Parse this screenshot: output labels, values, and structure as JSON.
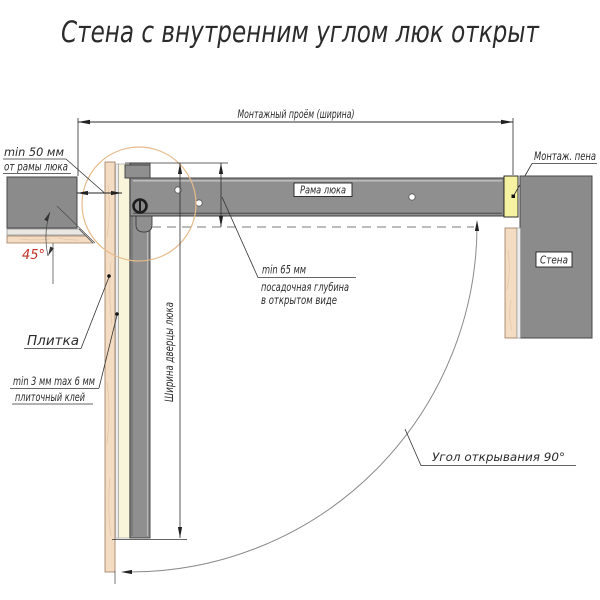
{
  "title": "Стена с внутренним углом люк открыт",
  "colors": {
    "wall_gray": "#8b8b8b",
    "frame_gray": "#8f8f8f",
    "tile_beige": "#f4dcc3",
    "adhesive_cream": "#f8f5da",
    "foam_yellow": "#f5f2a2",
    "detail_circle_orange": "#e7ba8b",
    "annotation_red": "#c43127",
    "line_dark": "#2e2e2e"
  },
  "labels": {
    "mounting_opening": "Монтажный проём (ширина)",
    "min50_line1": "min 50 мм",
    "min50_line2": "от рамы люка",
    "angle45": "45°",
    "tile": "Плитка",
    "adhesive_line1": "min 3 мм max 6 мм",
    "adhesive_line2": "плиточный клей",
    "frame": "Рама люка",
    "foam": "Монтаж. пена",
    "wall": "Стена",
    "depth_line1": "min 65 мм",
    "depth_line2": "посадочная глубина",
    "depth_line3": "в открытом виде",
    "door_width": "Ширина дверцы люка",
    "opening_angle": "Угол открывания 90°"
  }
}
